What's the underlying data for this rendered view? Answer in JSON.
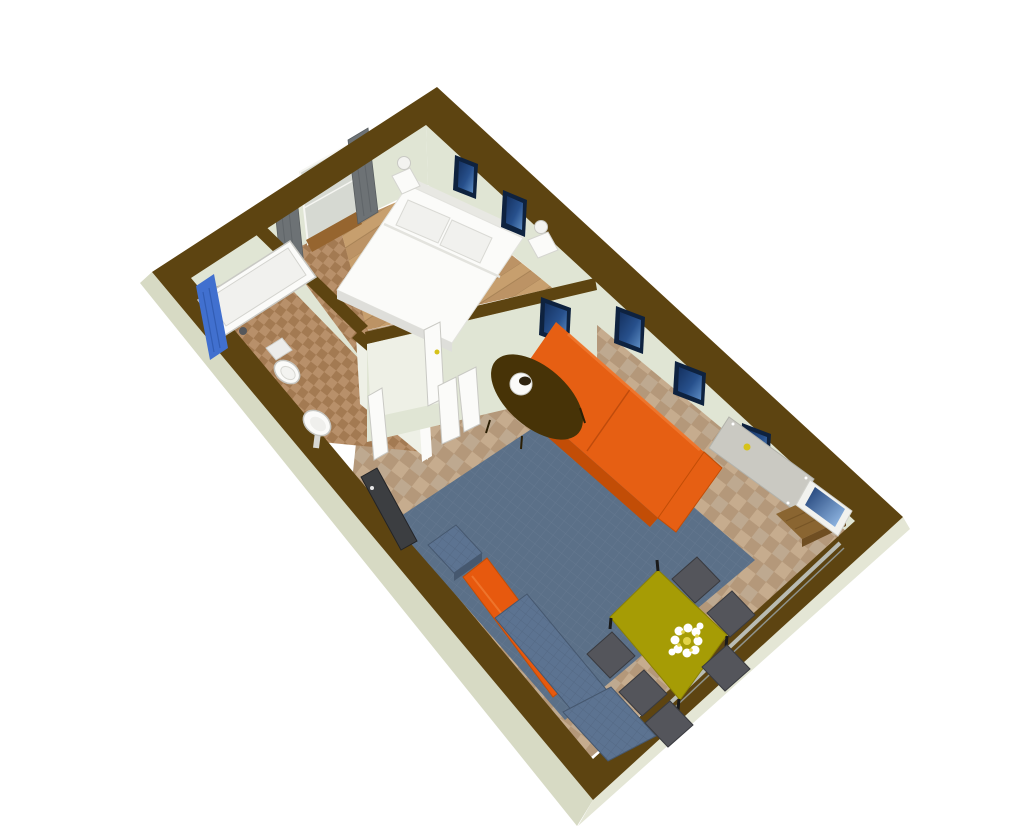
{
  "scene": {
    "type": "floor-plan-3d-render",
    "view": "aerial-oblique",
    "background": "#ffffff"
  },
  "colors": {
    "wall_top": "#5d4411",
    "wall_exterior": "#d7dac4",
    "wall_exterior_se": "#e4e6d5",
    "wall_interior": "#e0e5d4",
    "wall_interior_bright": "#eef0e6",
    "floor_tile_a": "#c6ac8e",
    "floor_tile_b": "#b4987a",
    "floor_tile_c": "#a8a099",
    "bath_tile_a": "#b8906a",
    "bath_tile_b": "#a37a52",
    "wood_a": "#c79f6e",
    "wood_b": "#b2895c",
    "rug": "#5b7088",
    "rug_line": "#76879c",
    "sofa": "#e65f13",
    "sofa_dark": "#c24d06",
    "denim": "#5c7391",
    "denim_dark": "#46586f",
    "sideboard": "#e7590e",
    "table_olive": "#a69c05",
    "table_olive_dark": "#8a8104",
    "chair": "#54555b",
    "chair_dark": "#393a3f",
    "white": "#fbfbf9",
    "white_shade": "#dededa",
    "curtain": "#6d7275",
    "curtain_dark": "#595e60",
    "picture_frame": "#0e223f",
    "picture_fill": "#27508c",
    "picture_light": "#9cc3ee",
    "shower": "#4170cf",
    "door_slab": "#cac9c2",
    "handle_yellow": "#d6c21a",
    "cabinet": "#8a6531",
    "cabinet_dark": "#6f4e22",
    "coffee_table": "#473307",
    "tv": "#3c3e41",
    "flower_petal": "#ffffff",
    "flower_center": "#e3d44a",
    "sill": "#b9bcb4",
    "window_glass": "#d6d9d2",
    "window_sill_wood": "#96652f"
  },
  "rooms": {
    "bathroom": {
      "name": "bathroom",
      "items": [
        "bathtub",
        "shower-curtain",
        "faucet",
        "toilet",
        "pedestal-sink",
        "bathroom-door"
      ]
    },
    "bedroom": {
      "name": "bedroom",
      "items": [
        "double-bed",
        "pillow",
        "pillow",
        "nightstand",
        "nightstand",
        "table-lamp",
        "table-lamp",
        "window",
        "curtain",
        "curtain",
        "wall-picture",
        "wall-picture",
        "bedroom-door"
      ]
    },
    "living_room": {
      "name": "living-room",
      "items": [
        "orange-sofa",
        "coffee-table",
        "table-lamp",
        "area-rug",
        "tv",
        "blue-armchair",
        "orange-sideboard",
        "blue-sectional-sofa",
        "dining-table",
        "flower-bouquet",
        "chair",
        "chair",
        "chair",
        "chair",
        "chair",
        "chair",
        "entrance-door",
        "wood-cabinet",
        "leaning-picture",
        "window-sill",
        "wall-picture",
        "wall-picture",
        "wall-picture",
        "wall-picture",
        "hall-double-doors"
      ]
    }
  }
}
